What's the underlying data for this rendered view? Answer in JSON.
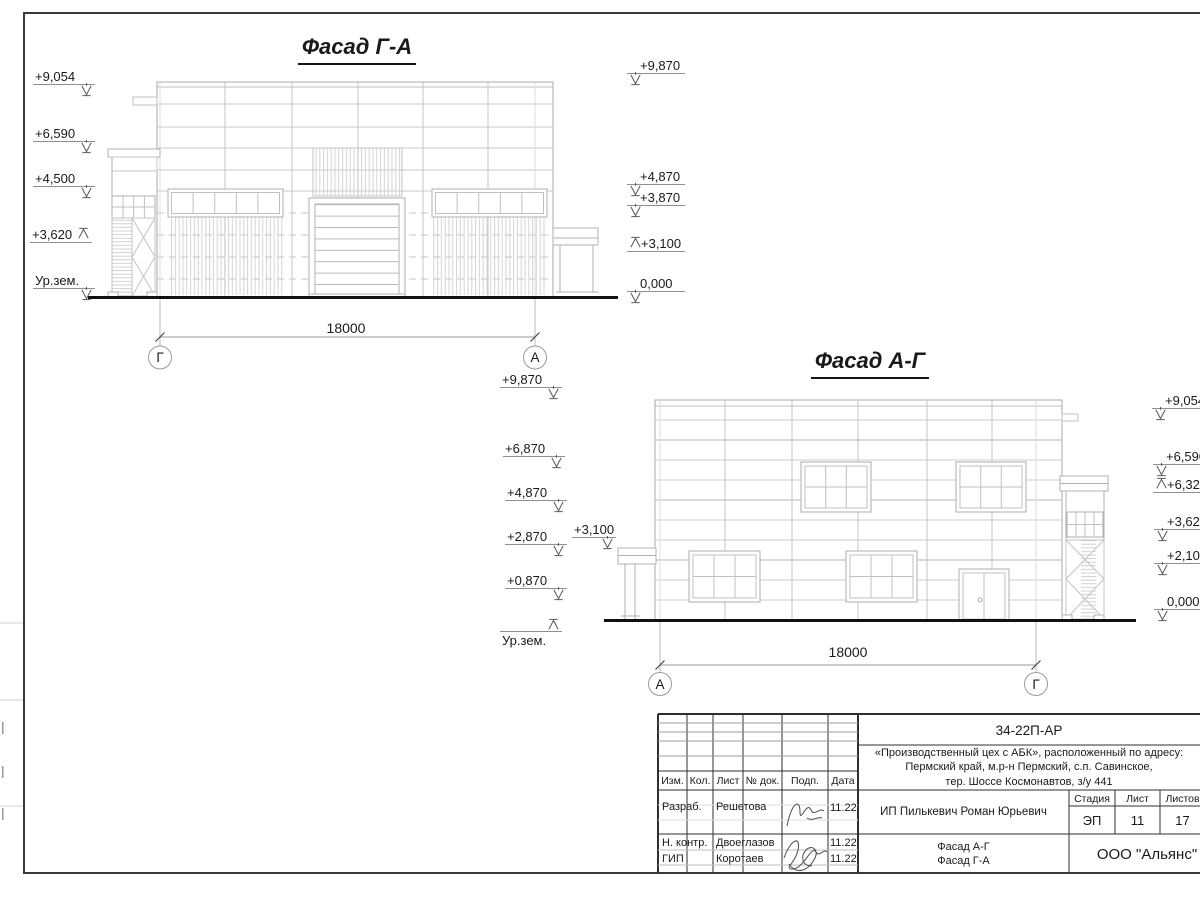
{
  "colors": {
    "ground_line": "#111111",
    "drawing_line_light": "#c9c9c9",
    "drawing_line_mid": "#aeaeae",
    "frame_line": "#3a3a3a"
  },
  "facade_ga": {
    "title": "Фасад Г-А",
    "marks_left": [
      "+9,054",
      "+6,590",
      "+4,500",
      "+3,620",
      "Ур.зем."
    ],
    "marks_right": [
      "+9,870",
      "+4,870",
      "+3,870",
      "+3,100",
      "0,000"
    ],
    "dim": "18000",
    "axis_left": "Г",
    "axis_right": "А"
  },
  "facade_ag": {
    "title": "Фасад А-Г",
    "marks_left": [
      "+9,870",
      "+6,870",
      "+4,870",
      "+2,870",
      "+0,870",
      "Ур.зем."
    ],
    "canopy_mark": "+3,100",
    "marks_right": [
      "+9,054",
      "+6,590",
      "+6,320",
      "+3,620",
      "+2,100",
      "0,000"
    ],
    "dim": "18000",
    "axis_left": "А",
    "axis_right": "Г"
  },
  "stamp": {
    "code": "34-22П-АР",
    "address_line1": "«Производственный цех с АБК», расположенный по адресу:",
    "address_line2": "Пермский край, м.р-н Пермский, с.п. Савинское,",
    "address_line3": "тер. Шоссе Космонавтов, з/у 441",
    "cols": [
      "Изм.",
      "Кол.",
      "Лист",
      "№ док.",
      "Подп.",
      "Дата"
    ],
    "rows": [
      {
        "role": "Разраб.",
        "name": "Решетова",
        "date": "11.22"
      },
      {
        "role": "Н. контр.",
        "name": "Двоеглазов",
        "date": "11.22"
      },
      {
        "role": "ГИП",
        "name": "Коротаев",
        "date": "11.22"
      }
    ],
    "client": "ИП Пилькевич Роман Юрьевич",
    "stage_label": "Стадия",
    "stage": "ЭП",
    "sheet_label": "Лист",
    "sheet": "11",
    "total_label": "Листов",
    "total": "17",
    "content_line1": "Фасад А-Г",
    "content_line2": "Фасад Г-А",
    "org": "ООО \"Альянс\""
  }
}
